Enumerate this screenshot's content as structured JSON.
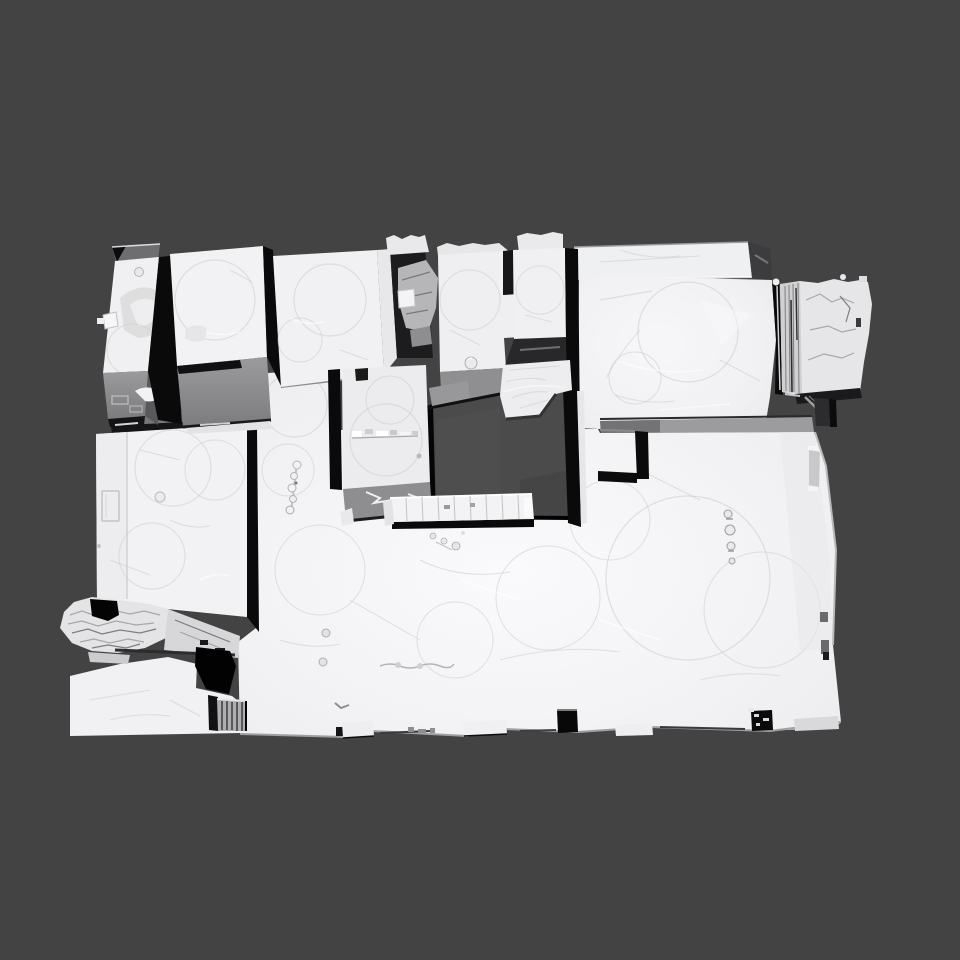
{
  "scene": {
    "description": "Untextured grayscale 3D mesh scan of a multi-room indoor space (apartment floor plan) viewed from an overhead oblique angle in a 3D viewer viewport with a plain dark gray background",
    "mesh_name": "indoor-scan-mesh",
    "regions": [
      "upper-room-a",
      "upper-room-b",
      "upper-room-c",
      "rubble-gap",
      "center-room-e",
      "center-room-f",
      "back-slab",
      "right-room",
      "right-wing-rough",
      "left-room",
      "torn-ledge",
      "floor-slab",
      "booth-box",
      "floor-opening",
      "crumpled-block",
      "shelf-unit",
      "step-notch",
      "door-gap-left",
      "door-gap-right",
      "ledge-1",
      "ledge-2",
      "ledge-3",
      "ledge-4",
      "stripe-object",
      "floor-hole",
      "knob-column",
      "corridor-objects",
      "floor-dots"
    ]
  },
  "colors": {
    "viewport_bg": "#434343",
    "mesh_top": "#f1f1f3",
    "mesh_side": "#96969a",
    "mesh_side_dark": "#717173",
    "crevice": "#0a0a0a",
    "opening_shadow": "#4b4b4b",
    "facet_line": "#d6d6d8",
    "rough_line": "#a0a0a2",
    "highlight": "#ffffff"
  }
}
